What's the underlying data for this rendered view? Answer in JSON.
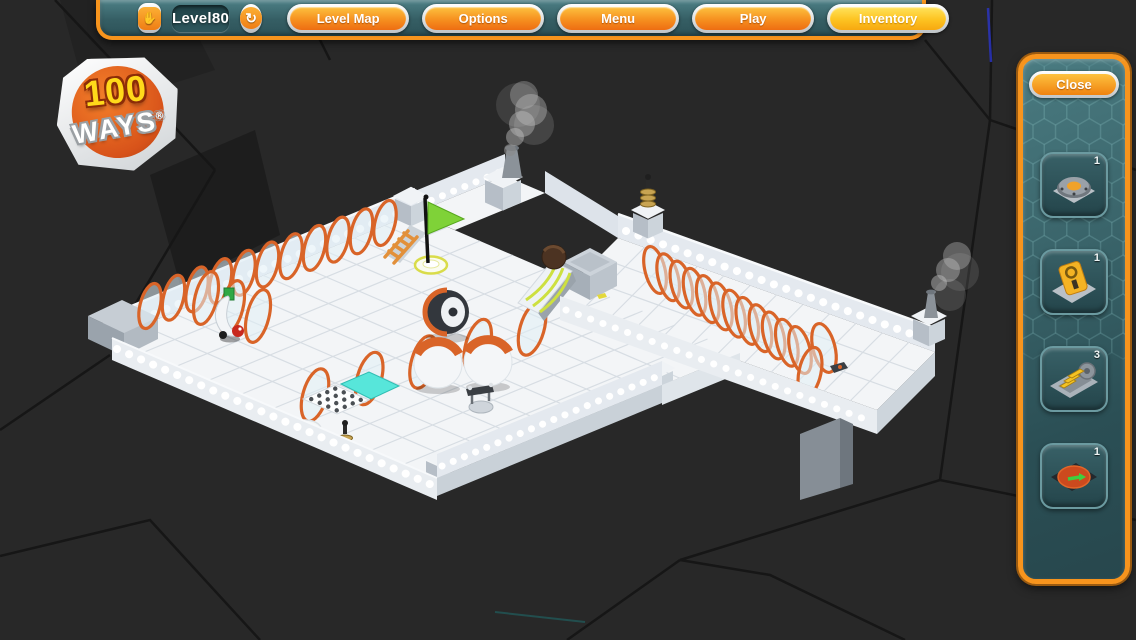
{
  "colors": {
    "accent_orange": "#f7941d",
    "panel_teal": "#3c6a70",
    "button_orange": "#f0820f",
    "highlight_yellow": "#fdc321",
    "ring_orange": "#d96428"
  },
  "top_bar": {
    "hand_glyph": "✋",
    "refresh_icon": "↻",
    "level_field": {
      "value": "Level80"
    },
    "buttons": [
      {
        "label": "Level Map"
      },
      {
        "label": "Options"
      },
      {
        "label": "Menu"
      },
      {
        "label": "Play"
      },
      {
        "label": "Inventory"
      }
    ]
  },
  "logo": {
    "top": "100",
    "bottom": "WAYS",
    "mark": "®"
  },
  "inventory_panel": {
    "close_label": "Close",
    "slots": [
      {
        "item": "pressure-plate",
        "count": "1"
      },
      {
        "item": "switch-card",
        "count": "1"
      },
      {
        "item": "conveyor-machine",
        "count": "3"
      },
      {
        "item": "teleport-pad",
        "count": "1"
      }
    ]
  }
}
